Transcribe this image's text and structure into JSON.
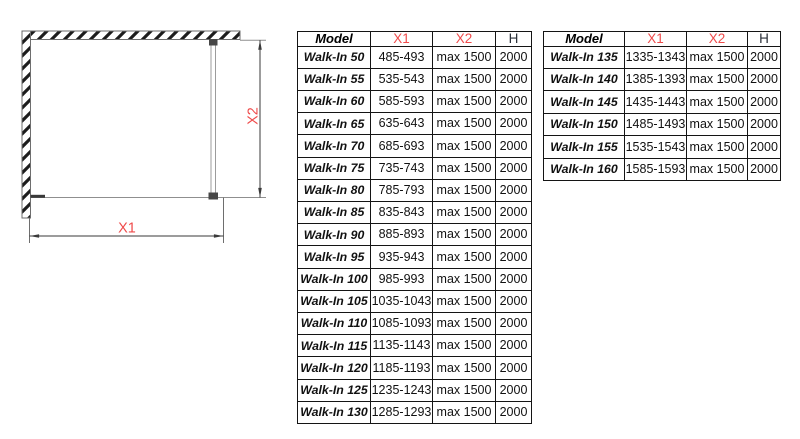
{
  "colors": {
    "accent_red": "#ef4b4b"
  },
  "diagram": {
    "x1_label": "X1",
    "x2_label": "X2"
  },
  "tables": [
    {
      "headers": [
        "Model",
        "X1",
        "X2",
        "H"
      ],
      "rows": [
        [
          "Walk-In 50",
          "485-493",
          "max 1500",
          "2000"
        ],
        [
          "Walk-In 55",
          "535-543",
          "max 1500",
          "2000"
        ],
        [
          "Walk-In 60",
          "585-593",
          "max 1500",
          "2000"
        ],
        [
          "Walk-In 65",
          "635-643",
          "max 1500",
          "2000"
        ],
        [
          "Walk-In 70",
          "685-693",
          "max 1500",
          "2000"
        ],
        [
          "Walk-In 75",
          "735-743",
          "max 1500",
          "2000"
        ],
        [
          "Walk-In 80",
          "785-793",
          "max 1500",
          "2000"
        ],
        [
          "Walk-In 85",
          "835-843",
          "max 1500",
          "2000"
        ],
        [
          "Walk-In 90",
          "885-893",
          "max 1500",
          "2000"
        ],
        [
          "Walk-In 95",
          "935-943",
          "max 1500",
          "2000"
        ],
        [
          "Walk-In 100",
          "985-993",
          "max 1500",
          "2000"
        ],
        [
          "Walk-In 105",
          "1035-1043",
          "max 1500",
          "2000"
        ],
        [
          "Walk-In 110",
          "1085-1093",
          "max 1500",
          "2000"
        ],
        [
          "Walk-In 115",
          "1135-1143",
          "max 1500",
          "2000"
        ],
        [
          "Walk-In 120",
          "1185-1193",
          "max 1500",
          "2000"
        ],
        [
          "Walk-In 125",
          "1235-1243",
          "max 1500",
          "2000"
        ],
        [
          "Walk-In 130",
          "1285-1293",
          "max 1500",
          "2000"
        ]
      ]
    },
    {
      "headers": [
        "Model",
        "X1",
        "X2",
        "H"
      ],
      "rows": [
        [
          "Walk-In 135",
          "1335-1343",
          "max 1500",
          "2000"
        ],
        [
          "Walk-In 140",
          "1385-1393",
          "max 1500",
          "2000"
        ],
        [
          "Walk-In 145",
          "1435-1443",
          "max 1500",
          "2000"
        ],
        [
          "Walk-In 150",
          "1485-1493",
          "max 1500",
          "2000"
        ],
        [
          "Walk-In 155",
          "1535-1543",
          "max 1500",
          "2000"
        ],
        [
          "Walk-In 160",
          "1585-1593",
          "max 1500",
          "2000"
        ]
      ]
    }
  ]
}
